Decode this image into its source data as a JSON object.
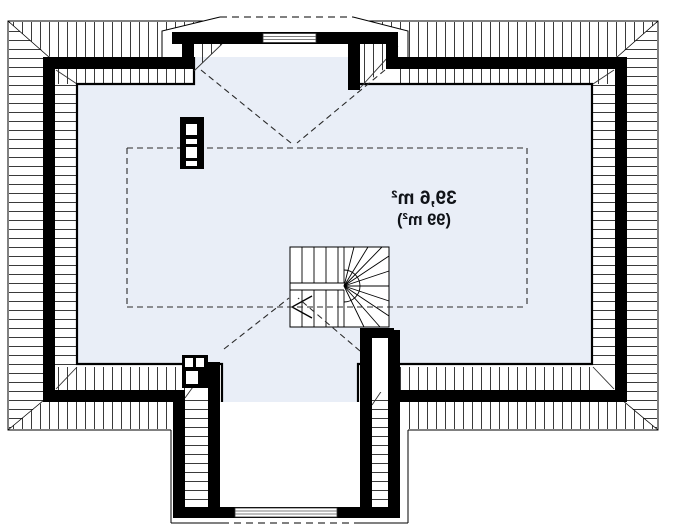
{
  "plan": {
    "area_label_line1": "39,6 m²",
    "area_label_line2": "(99 m²)"
  },
  "colors": {
    "background": "#ffffff",
    "interior_fill": "#e9eef7",
    "wall": "#000000",
    "hatch_line": "#3a3a3a",
    "dashed_line": "#2a2a2a"
  }
}
